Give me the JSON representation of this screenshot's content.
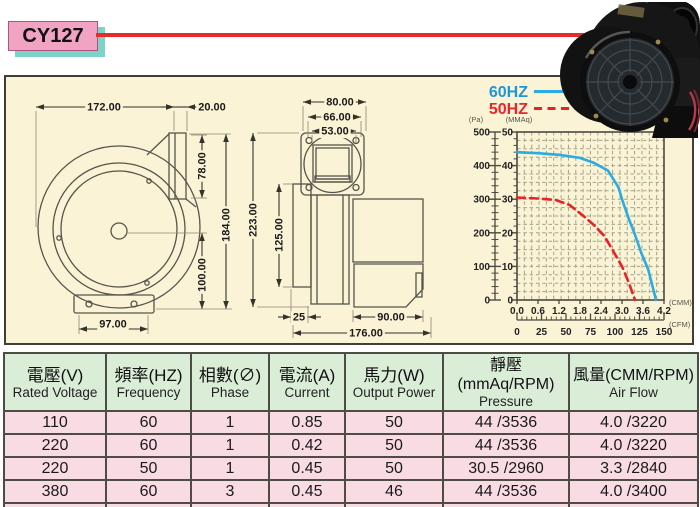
{
  "title": {
    "model": "CY127"
  },
  "legend": {
    "hz60": "60HZ",
    "hz50": "50HZ"
  },
  "front_view": {
    "dim_width": "172.00",
    "dim_outlet_w": "20.00",
    "dim_outlet_h": "78.00",
    "dim_total_h": "184.00",
    "dim_center_h": "100.00",
    "dim_base_w": "97.00"
  },
  "side_view": {
    "dim_flange_w": "80.00",
    "dim_bolt_pitch": "66.00",
    "dim_opening_w": "53.00",
    "dim_total_h": "223.00",
    "dim_body_h": "125.00",
    "dim_foot_w": "25",
    "dim_motor_w": "90.00",
    "dim_total_w": "176.00"
  },
  "chart_data": {
    "type": "line",
    "title": "Air performance curves",
    "legend_position": "top-left",
    "grid": {
      "on": true,
      "minor_x": 20,
      "minor_y": 20
    },
    "x_axis": {
      "unit_top": "(CMM)",
      "ticks_cmm": [
        "0.0",
        "0.6",
        "1.2",
        "1.8",
        "2.4",
        "3.0",
        "3.6",
        "4.2"
      ],
      "unit_bottom": "(CFM)",
      "ticks_cfm": [
        "0",
        "25",
        "50",
        "75",
        "100",
        "125",
        "150"
      ],
      "xlim_cmm": [
        0,
        4.2
      ]
    },
    "y_axis": {
      "unit_left": "(Pa)",
      "ticks_pa": [
        "500",
        "400",
        "300",
        "200",
        "100",
        "0"
      ],
      "unit_right": "(MMAq)",
      "ticks_mmaq": [
        "50",
        "40",
        "30",
        "20",
        "10",
        "0"
      ],
      "ylim_mmaq": [
        0,
        50
      ]
    },
    "series": [
      {
        "name": "60HZ",
        "color": "#2aabe2",
        "style": "solid",
        "points_cmm_mmaq": [
          [
            0,
            44
          ],
          [
            0.6,
            43.7
          ],
          [
            1.2,
            43.2
          ],
          [
            1.8,
            42.3
          ],
          [
            2.2,
            40.8
          ],
          [
            2.6,
            38.5
          ],
          [
            2.9,
            33.5
          ],
          [
            3.0,
            30
          ],
          [
            3.2,
            24
          ],
          [
            3.35,
            20
          ],
          [
            3.55,
            14
          ],
          [
            3.75,
            9
          ],
          [
            3.97,
            0
          ]
        ]
      },
      {
        "name": "50HZ",
        "color": "#ed2024",
        "style": "dashed",
        "points_cmm_mmaq": [
          [
            0,
            30.5
          ],
          [
            0.6,
            30.2
          ],
          [
            1.1,
            29.8
          ],
          [
            1.5,
            28.3
          ],
          [
            1.9,
            25
          ],
          [
            2.2,
            22.3
          ],
          [
            2.5,
            19
          ],
          [
            2.75,
            14.5
          ],
          [
            3.0,
            10
          ],
          [
            3.2,
            5
          ],
          [
            3.37,
            0
          ]
        ]
      }
    ]
  },
  "table": {
    "headers": [
      {
        "zh": "電壓(V)",
        "en": "Rated Voltage"
      },
      {
        "zh": "頻率(HZ)",
        "en": "Frequency"
      },
      {
        "zh": "相數(∅)",
        "en": "Phase"
      },
      {
        "zh": "電流(A)",
        "en": "Current"
      },
      {
        "zh": "馬力(W)",
        "en": "Output Power"
      },
      {
        "zh": "靜壓(mmAq/RPM)",
        "en": "Pressure"
      },
      {
        "zh": "風量(CMM/RPM)",
        "en": "Air Flow"
      }
    ],
    "rows": [
      [
        "110",
        "60",
        "1",
        "0.85",
        "50",
        "44 /3536",
        "4.0 /3220"
      ],
      [
        "220",
        "60",
        "1",
        "0.42",
        "50",
        "44 /3536",
        "4.0 /3220"
      ],
      [
        "220",
        "50",
        "1",
        "0.45",
        "50",
        "30.5 /2960",
        "3.3 /2840"
      ],
      [
        "380",
        "60",
        "3",
        "0.45",
        "46",
        "44 /3536",
        "4.0 /3400"
      ],
      [
        "380",
        "50",
        "3",
        "0.3",
        "46",
        "30.5 /2960",
        "3.3 /2840"
      ]
    ]
  },
  "colors": {
    "accent_red": "#e62b28",
    "hz60_blue": "#2aabe2",
    "hz50_red": "#ed2024",
    "title_bg_pink": "#f0a3c2",
    "title_shadow_teal": "#7fd2c7",
    "panel_bg_cream": "#faf3d5",
    "table_header_green": "#d9edd7",
    "table_row_pink": "#f9dce3"
  }
}
